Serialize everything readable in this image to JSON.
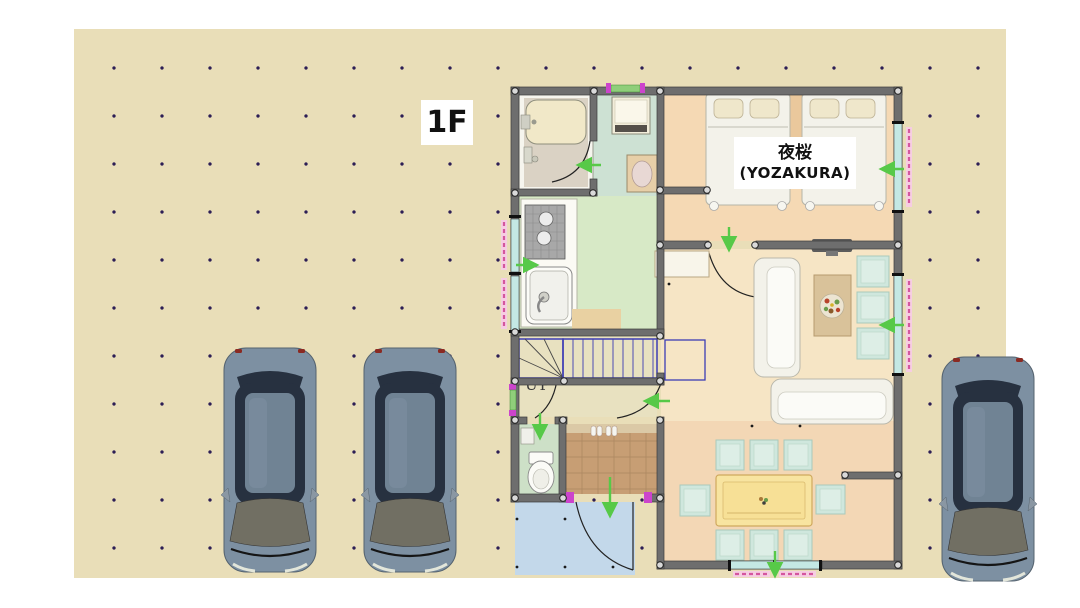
{
  "plan": {
    "floor_label": "1F",
    "bedroom_label_jp": "夜桜",
    "bedroom_label_en": "(YOZAKURA)",
    "stairs_label": "UP"
  },
  "cars": {
    "count": 3
  },
  "colors": {
    "page_bg": "#ffffff",
    "canvas_bg": "#e9deb8",
    "grid_dot": "#2c1e55",
    "wall": "#6e6e6e",
    "bedroom_floor": "#f5d9b4",
    "living_floor": "#f6e5c5",
    "dining_floor": "#f3d7b5",
    "kitchen_floor": "#d7e9c6",
    "washroom_floor": "#cde1d3",
    "bathroom_floor": "#dad2c4",
    "toilet_floor": "#cde0c7",
    "hall_floor": "#e8e1c0",
    "entrance_tile": "#c79e74",
    "porch": "#c3d8ea",
    "stair_line": "#3c3cb4",
    "window_glass": "#c4e8e4",
    "window_green": "#8fce7a",
    "shutter_pink": "#f6cde2",
    "shutter_dash": "#d4569e",
    "marker_magenta": "#cc44cc",
    "arrow_green": "#57c948",
    "furniture_white": "#f3f2ea",
    "cushion_teal": "#cfe7dd",
    "table_yellow": "#f8e4a0",
    "table_wood": "#d9c29a",
    "bed_pillow": "#efe7cb",
    "tub_cream": "#f1e8c8",
    "car_body": "#7d90a2",
    "car_dark": "#273140",
    "car_glass": "#716f63",
    "label_text": "#111111"
  }
}
